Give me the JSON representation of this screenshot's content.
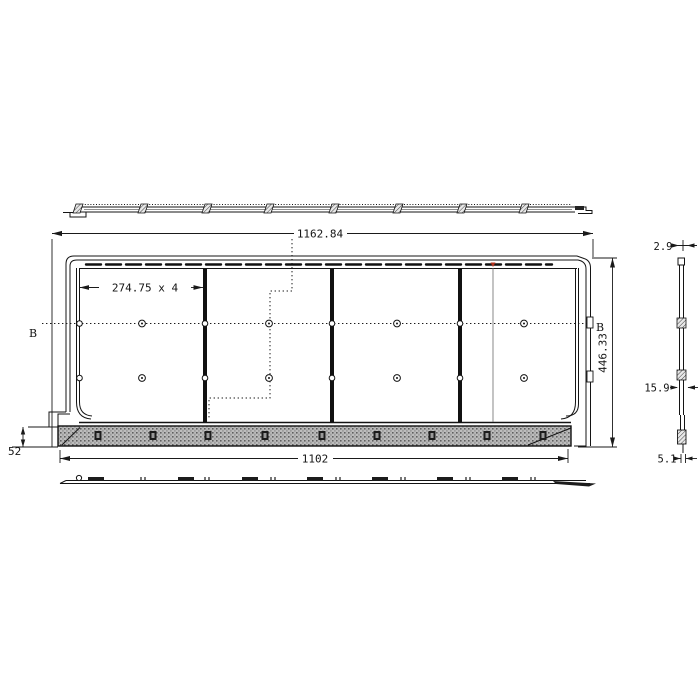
{
  "dimensions": {
    "overall_width": "1162.84",
    "panel_pitch": "274.75 x 4",
    "overall_height": "446.33",
    "flange_width": "1102",
    "flange_height": "52",
    "top_lip_thickness": "2.9",
    "panel_thickness": "15.9",
    "bottom_lip_thickness": "5.1"
  },
  "section_labels": {
    "left": "B",
    "right": "B"
  },
  "colors": {
    "line": "#141414",
    "hatch_fill": "#bdbdbd",
    "hatch_speckle": "#5f5f5f",
    "seam_marker": "#b5341f",
    "background": "#ffffff"
  }
}
